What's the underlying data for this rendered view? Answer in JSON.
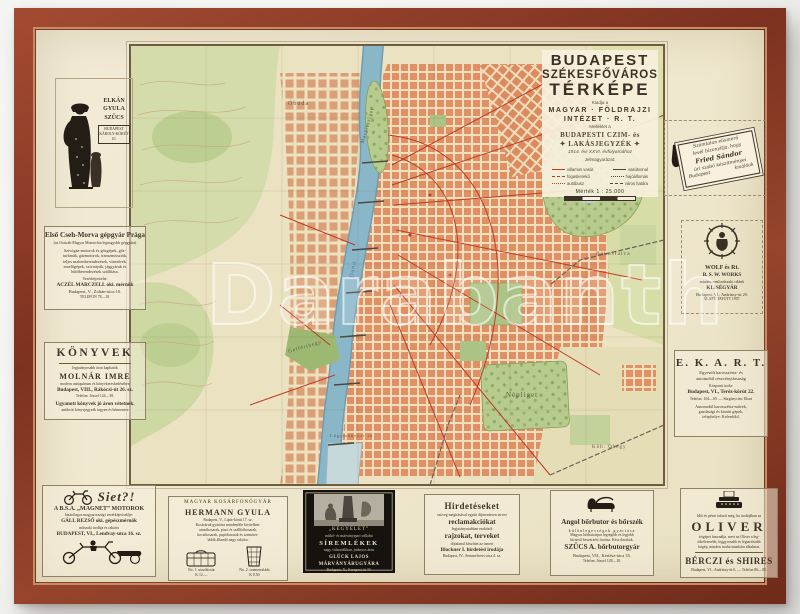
{
  "photo": {
    "watermark": "Darabanth"
  },
  "colors": {
    "frame_wood": "#8a3a26",
    "paper": "#efe7cd",
    "river": "#86b4c6",
    "urban_blocks": "#e09064",
    "parks": "#b7cb8e",
    "main_roads": "#c23a25",
    "ink": "#3e342a"
  },
  "map": {
    "title_block": {
      "line1": "BUDAPEST",
      "line2": "SZÉKESFŐVÁROS",
      "line3": "TÉRKÉPE",
      "small1": "Kiadja a",
      "publisher1": "MAGYAR · FÖLDRAJZI",
      "publisher2": "INTÉZET · R. T.",
      "small2": "Melléklet a",
      "directory1": "BUDAPESTI CZIM- és",
      "directory2": "✦ LAKÁSJEGYZÉK ✦",
      "edition": "1914. évi XXVI. évfolyamához",
      "legend_title": "Jelmagyarázat:",
      "legend": [
        {
          "label_left": "villamos vasút",
          "label_right": "vasútvonal"
        },
        {
          "label_left": "fogaskerekű",
          "label_right": "hajóállomás"
        },
        {
          "label_left": "autóbusz",
          "label_right": "város határa"
        }
      ],
      "scale": "Mérték 1 : 25.000"
    },
    "labels": [
      "Óbuda",
      "Margitsziget",
      "Városliget",
      "Rákosfalva",
      "Gellérthegy",
      "Népliget",
      "Kőb. Óhegy",
      "Lágymányosi tó",
      "Duna"
    ]
  },
  "ads": {
    "elkan": {
      "lines": [
        "ELKÁN",
        "GYULA",
        "SZŰCS",
        "BUDAPEST",
        "KÁROLY-KÖRÚT 10."
      ]
    },
    "cseh_morva": {
      "title": "Első Cseh-Morva gépgyár Prága",
      "subtitle": "(az Osztrák-Magyar Monarchia legnagyobb gépgyára)",
      "body1": "Szivógáz-motorok és gőzgépek, gőz-",
      "body2": "turbinák, gázmotorok, transzmissziók,",
      "body3": "teljes malomberendezések, vízművek,",
      "body4": "emelőgépek, szivattyúk, jéggyárak és",
      "body5": "hűtőberendezések szállítása.",
      "rep": "Vezérképviselet:",
      "name": "ACZÉL MARCZELL oki. mérnök",
      "addr": "Budapest, V., Zoltán-utca 10.",
      "tel": "TELEFON 78—18."
    },
    "konyvek": {
      "title": "KÖNYVEK",
      "sub": "legjutányosabb áron kaphatók",
      "name": "MOLNÁR IMRE",
      "sub2": "modern antiquárium és könyvkereskedésében",
      "addr": "Budapest, VIII., Rákóczi-út 26. sz.",
      "tel": "Telefon: József 124—38.",
      "note": "Ugyanott könyvek jó áron vétetnek.",
      "note2": "antikvár könyvjegyzék ingyen és bérmentve"
    },
    "siet": {
      "title": "Siet?!",
      "line1": "A B.S.A. „MAGNET” MOTOROK",
      "line2": "kizárólagos magyarországi vezérképviselője:",
      "name": "GÁLL REZSŐ oki. gépészmérnök",
      "line3": "műszaki irodája és raktára",
      "addr": "BUDAPEST, VI., Lendvay-utca 16. sz."
    },
    "business_card": {
      "script1": "Számtalan elismerő",
      "script2": "levél bizonyítja, hogy",
      "script3": "Fried Sándor",
      "script4": "úri szabó készítményei",
      "script5": "Budapest",
      "script6": "kiválóak"
    },
    "wolf": {
      "l1": "WOLF és Rt.",
      "l2": "B. S. W. WORKS",
      "l3": "mindennemű műszaki cikkek",
      "l4": "KLISÉGYÁR",
      "l5": "Budapest, VI., Andrássy-út 29.",
      "l6": "ALAPÍTTATOTT 1907."
    },
    "ekart": {
      "big": "E. K. A. R. T.",
      "l1": "Egyesült karosszéria- és",
      "l2": "automobil részvénytársaság",
      "l3": "Központi iroda:",
      "addr": "Budapest, VI., Teréz-körút 22.",
      "l4": "Telefon: 104—05. — Sürgönycím: Ekart",
      "l5": "Automobil karosszéria-művek,",
      "l6": "gazdasági és közúti gépek,",
      "l7": "telephelye: Kelenföld."
    },
    "oliver": {
      "top": "Időt és pénzt takarít meg, ha irodájában az",
      "big": "OLIVER",
      "t1": "írógépet használja, mert az Oliver a leg-",
      "t2": "tökéletesebb, leggyorsabb és legtartósabb",
      "t3": "írógép, minden irodai munkára alkalmas.",
      "name": "BÉRCZI és SHIRES",
      "addr": "Budapest, VI., Andrássy-út 6. — Telefon 86—05."
    },
    "hermann": {
      "top": "MAGYAR KOSÁRFONÓGYÁR",
      "name": "HERMANN GYULA",
      "addr": "Budapest, V., Lipót-körút 17. sz.",
      "b1": "Kosáráruk gyártása mindenféle kivitelben:",
      "b2": "utazókosarak, piaci és szállítókosarak,",
      "b3": "kocsikosarak, papírkosarak és szemetes-",
      "b4": "ládák állandó nagy raktára.",
      "cap1": "No. 1. utazókosár",
      "price1": "K 12.—",
      "cap2": "No. 2. szemetesláda",
      "price2": "K 8.50"
    },
    "siremlekek": {
      "l1": "„KEGYELET”",
      "l2": "műkő- és márványipari vállalat",
      "l3": "SÍREMLÉKEK",
      "l4": "nagy választékban, jutányos áron",
      "l5": "GLÜCK LAJOS MÁRVÁNYÁRUGYÁRA",
      "l6": "Budapest, X., Kerepesi-út 44."
    },
    "blockner": {
      "l1": "Hirdetéseket",
      "t1": "szöveg megírásával együtt díjmentesen tervez",
      "l2": "reclamakciókat",
      "t2": "legjutányosabban eszközöl",
      "l3": "rajzokat, terveket",
      "t3": "díjtalanul készíttet az ismert",
      "name": "Blockner I. hirdetési irodája",
      "addr": "Budapest, IV., Semmelweis-utca 4. sz."
    },
    "szucs": {
      "title": "Angol bőrbutor és bőrszék",
      "sub": "különlegességek gyártása",
      "t1": "Magyar bőrbutoripar legrégibb és legjobb",
      "t2": "hírnevű beszerzési forrása. Kész darabok.",
      "name": "SZŰCS A. bőrbutorgyár",
      "addr": "Budapest, VII., Kertész-utca 35.",
      "tel": "Telefon: József 128—10."
    }
  }
}
